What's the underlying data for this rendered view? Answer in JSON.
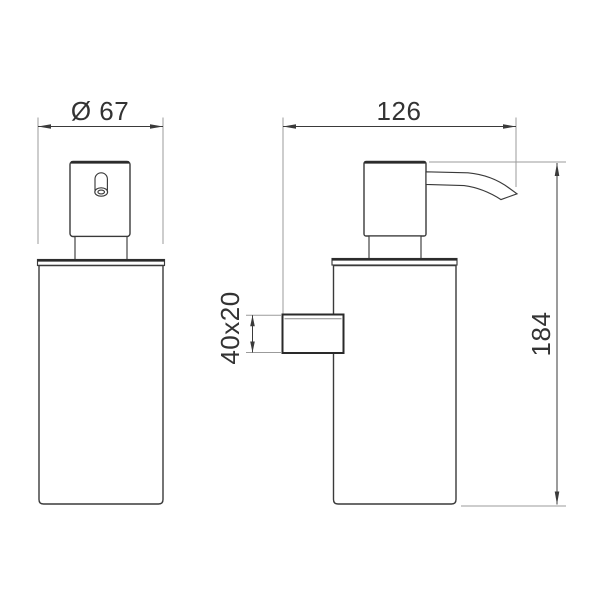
{
  "drawing": {
    "views": {
      "front": "front-view",
      "side": "side-view"
    },
    "labels": {
      "front_diameter": "Ø 67",
      "side_depth": "126",
      "total_height": "184",
      "bracket_size": "40x20"
    },
    "colors": {
      "line": "#3a3a3a",
      "edge": "#2a2a2a",
      "extension_line": "#9b9b9b",
      "text": "#333333",
      "background": "#ffffff"
    }
  }
}
